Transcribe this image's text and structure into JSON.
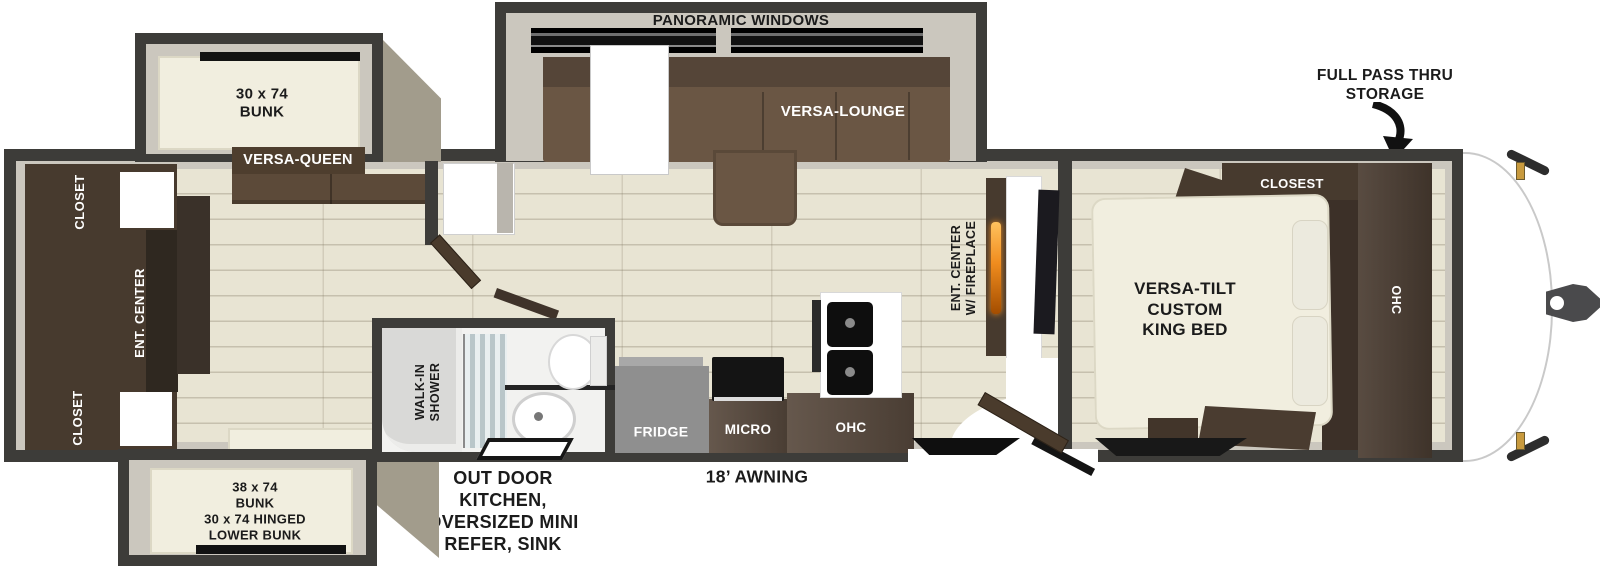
{
  "labels": {
    "storage": "FULL PASS THRU\nSTORAGE",
    "panoramic_windows": "PANORAMIC WINDOWS",
    "versa_lounge": "VERSA-LOUNGE",
    "bunk_top": "30 x 74\nBUNK",
    "versa_queen": "VERSA-QUEEN",
    "closet_top": "CLOSET",
    "ent_center_rear": "ENT. CENTER",
    "closet_bottom": "CLOSET",
    "bunk_bottom": "38 x 74\nBUNK\n30 x 74 HINGED\nLOWER BUNK",
    "walk_in_shower": "WALK-IN\nSHOWER",
    "outdoor_kitchen": "OUT DOOR\nKITCHEN,\nOVERSIZED MINI\nREFER, SINK",
    "awning": "18’ AWNING",
    "fridge": "FRIDGE",
    "micro": "MICRO",
    "ohc_kitchen": "OHC",
    "ent_center_fireplace": "ENT. CENTER\nW/ FIREPLACE",
    "closet_bedroom": "CLOSEST",
    "ohc_bedroom": "OHC",
    "king_bed": "VERSA-TILT\nCUSTOM\nKING BED"
  },
  "colors": {
    "wall": "#3d3c39",
    "liner": "#cbc7be",
    "floor": "#e8e4d3",
    "cream": "#f1eedf",
    "sofa": "#6a5644",
    "sofa-dark": "#554538",
    "cabinet": "#473a2e",
    "cabinet-dark": "#2f2820",
    "counter-wood": "#5a4b3f",
    "fridge": "#8f8f8f",
    "taupe": "#a29c8c",
    "flame": "#f08c1e",
    "amber": "#c89a3e",
    "text": "#1b1b1b"
  }
}
